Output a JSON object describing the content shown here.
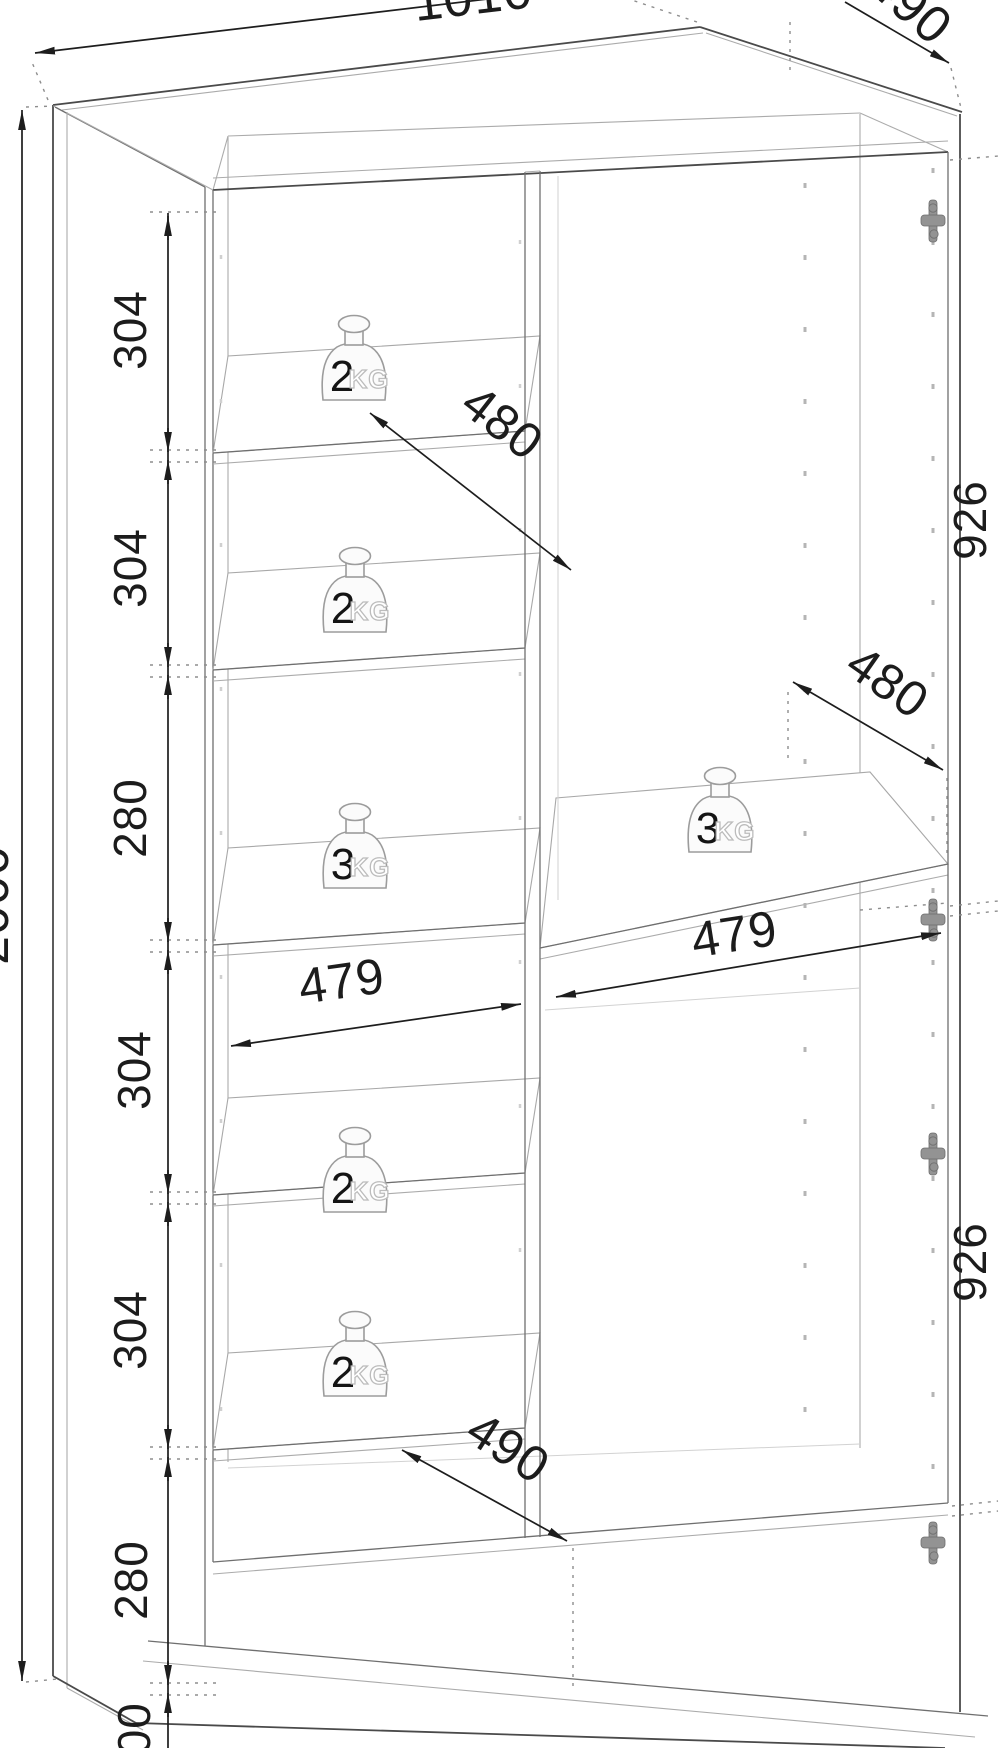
{
  "drawing": {
    "type": "furniture technical drawing",
    "subject": "two-door wardrobe carcass with shelves, dimensioned in millimetres"
  },
  "dimensions": {
    "top_width": "1010",
    "top_depth": "490",
    "total_height": "2000",
    "height_chain": [
      "304",
      "304",
      "280",
      "304",
      "304",
      "280",
      "100"
    ],
    "door_heights": [
      "926",
      "926"
    ],
    "compartment_widths": [
      "479",
      "479"
    ],
    "shelf_depths": [
      "480",
      "480",
      "490"
    ]
  },
  "weights": [
    {
      "value": "2",
      "unit": "KG"
    },
    {
      "value": "2",
      "unit": "KG"
    },
    {
      "value": "3",
      "unit": "KG"
    },
    {
      "value": "2",
      "unit": "KG"
    },
    {
      "value": "2",
      "unit": "KG"
    },
    {
      "value": "3",
      "unit": "KG"
    }
  ]
}
